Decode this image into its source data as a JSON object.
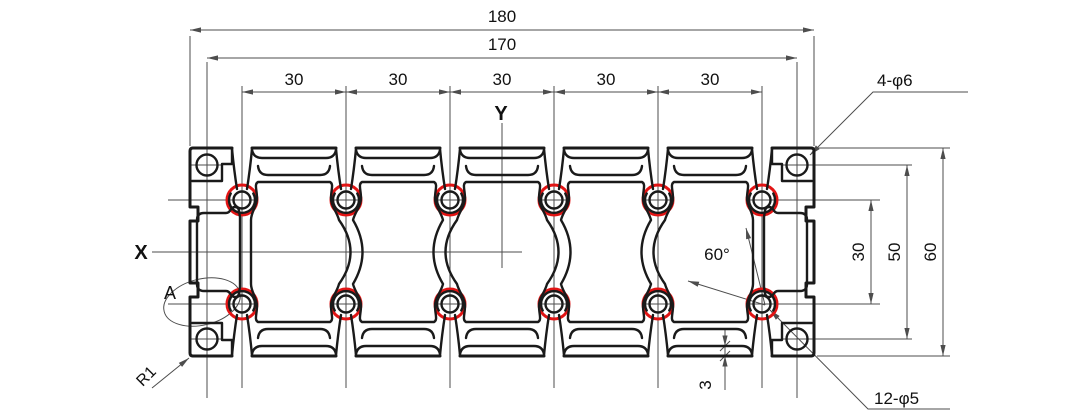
{
  "title": "aluminum-extrusion-cross-section-drawing",
  "axes": {
    "x": "X",
    "y": "Y"
  },
  "labels": {
    "detail": "A",
    "corner_radius": "R1",
    "corner_holes_note": "4-φ6",
    "screw_holes_note": "12-φ5",
    "angle": "60°"
  },
  "dims": {
    "overall_width": "180",
    "hole_pitch_width": "170",
    "slot_pitch": [
      "30",
      "30",
      "30",
      "30",
      "30"
    ],
    "boss_row_spacing": "30",
    "corner_hole_spacing": "50",
    "overall_height": "60",
    "wall_thickness": "3"
  },
  "colors": {
    "line": "#1a1a1a",
    "highlight": "#e21414",
    "thin": "#4d4d4d",
    "text": "#111111",
    "background": "#ffffff"
  }
}
